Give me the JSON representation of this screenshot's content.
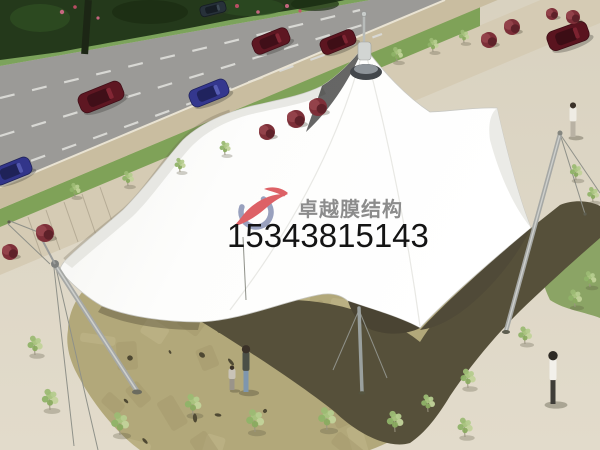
{
  "watermark": {
    "brand_text": "卓越膜结构",
    "phone_number": "15343815143",
    "brand_color": "#8c8c8c",
    "phone_color": "#141414",
    "logo": {
      "arc_color": "#99a1be",
      "swoosh_color": "#dd6166"
    }
  },
  "scene": {
    "palette": {
      "plaza_top": "#d9d2c0",
      "plaza_bottom": "#e2dbcb",
      "road": "#9b9a97",
      "lane_dash": "#d8d8d4",
      "curb": "#c9bda0",
      "sidewalk": "#d5cbb4",
      "verge_green": "#7fa258",
      "grass_patch": "#8ba465",
      "tree_mass": "#24391b",
      "stone": "#b2a87a",
      "stone_facet_light": "#c3ba8e",
      "stone_facet_dark": "#a1976a",
      "stone_spot": "#3d3827",
      "shadow": "#56503a",
      "canopy": "#fdfdfc",
      "canopy_edge": "#c8c8c3",
      "mast": "#a6a8a5",
      "cable": "#8f9189",
      "trunk": "#9a9480",
      "tree_greens": [
        "#a9c47e",
        "#8fb368",
        "#c2d39a",
        "#9cba74",
        "#b5cc8e",
        "#8aab60"
      ],
      "bush_main": "#7d2f38",
      "bush_light": "#93424a",
      "bush_dark": "#5e2129"
    },
    "cars": [
      {
        "x": 101,
        "y": 97,
        "w": 46,
        "h": 20,
        "angle": -22,
        "body": "#5e1722",
        "roof": "#400f18",
        "glass": "#822634"
      },
      {
        "x": 209,
        "y": 93,
        "w": 40,
        "h": 18,
        "angle": -22,
        "body": "#34378e",
        "roof": "#20235e",
        "glass": "#565cb4"
      },
      {
        "x": 12,
        "y": 171,
        "w": 40,
        "h": 18,
        "angle": -22,
        "body": "#32358a",
        "roof": "#1f2258",
        "glass": "#5257ae"
      },
      {
        "x": 271,
        "y": 41,
        "w": 38,
        "h": 17,
        "angle": -22,
        "body": "#5e1722",
        "roof": "#400f18",
        "glass": "#822634"
      },
      {
        "x": 338,
        "y": 42,
        "w": 36,
        "h": 16,
        "angle": -22,
        "body": "#5c1520",
        "roof": "#3e0e16",
        "glass": "#7e2432"
      },
      {
        "x": 568,
        "y": 36,
        "w": 42,
        "h": 20,
        "angle": -20,
        "body": "#5a141f",
        "roof": "#3c0d15",
        "glass": "#7c2230"
      },
      {
        "x": 213,
        "y": 9,
        "w": 26,
        "h": 11,
        "angle": -14,
        "body": "#27313a",
        "roof": "#161d24",
        "glass": "#3c4954"
      }
    ],
    "trees": [
      {
        "x": 75,
        "y": 197,
        "s": 0.8
      },
      {
        "x": 128,
        "y": 186,
        "s": 0.85
      },
      {
        "x": 180,
        "y": 172,
        "s": 0.8
      },
      {
        "x": 225,
        "y": 155,
        "s": 0.8
      },
      {
        "x": 397,
        "y": 62,
        "s": 0.85
      },
      {
        "x": 433,
        "y": 52,
        "s": 0.8
      },
      {
        "x": 464,
        "y": 43,
        "s": 0.75
      },
      {
        "x": 576,
        "y": 180,
        "s": 0.9
      },
      {
        "x": 593,
        "y": 202,
        "s": 0.85
      },
      {
        "x": 590,
        "y": 287,
        "s": 0.9
      },
      {
        "x": 35,
        "y": 355,
        "s": 1.1
      },
      {
        "x": 50,
        "y": 410,
        "s": 1.2
      },
      {
        "x": 120,
        "y": 435,
        "s": 1.3
      },
      {
        "x": 193,
        "y": 415,
        "s": 1.2
      },
      {
        "x": 255,
        "y": 432,
        "s": 1.3
      },
      {
        "x": 327,
        "y": 430,
        "s": 1.3
      },
      {
        "x": 395,
        "y": 432,
        "s": 1.2
      },
      {
        "x": 428,
        "y": 412,
        "s": 1.0
      },
      {
        "x": 468,
        "y": 388,
        "s": 1.1
      },
      {
        "x": 465,
        "y": 437,
        "s": 1.1
      },
      {
        "x": 525,
        "y": 344,
        "s": 1.0
      },
      {
        "x": 575,
        "y": 307,
        "s": 1.0
      }
    ],
    "bushes": [
      {
        "x": 573,
        "y": 17,
        "r": 7
      },
      {
        "x": 552,
        "y": 14,
        "r": 6
      },
      {
        "x": 512,
        "y": 27,
        "r": 8
      },
      {
        "x": 489,
        "y": 40,
        "r": 8
      },
      {
        "x": 318,
        "y": 107,
        "r": 9
      },
      {
        "x": 296,
        "y": 119,
        "r": 9
      },
      {
        "x": 267,
        "y": 132,
        "r": 8
      },
      {
        "x": 45,
        "y": 233,
        "r": 9
      },
      {
        "x": 10,
        "y": 252,
        "r": 8
      }
    ],
    "flowers": [
      {
        "x": 62,
        "y": 12,
        "r": 2.2,
        "c": "#d66a8a"
      },
      {
        "x": 75,
        "y": 7,
        "r": 1.8,
        "c": "#c94f6b"
      },
      {
        "x": 98,
        "y": 18,
        "r": 1.6,
        "c": "#d66a8a"
      },
      {
        "x": 237,
        "y": 6,
        "r": 2.0,
        "c": "#c94f6b"
      },
      {
        "x": 258,
        "y": 12,
        "r": 1.8,
        "c": "#d66a8a"
      },
      {
        "x": 287,
        "y": 6,
        "r": 2.0,
        "c": "#d66a8a"
      },
      {
        "x": 300,
        "y": 11,
        "r": 1.6,
        "c": "#c94f6b"
      }
    ],
    "people": [
      {
        "x": 246,
        "feet": 392,
        "h": 46,
        "shirt": "#4b4f46",
        "pants": "#7e96ae",
        "head": "#3a3128"
      },
      {
        "x": 232,
        "feet": 390,
        "h": 24,
        "shirt": "#c9c3b8",
        "pants": "#9a948a",
        "head": "#3a3128"
      },
      {
        "x": 553,
        "feet": 404,
        "h": 52,
        "shirt": "#f2f0ea",
        "pants": "#3f3d38",
        "head": "#2e2a24"
      },
      {
        "x": 573,
        "feet": 137,
        "h": 34,
        "shirt": "#efece4",
        "pants": "#b9b2a4",
        "head": "#3a3128"
      }
    ]
  }
}
